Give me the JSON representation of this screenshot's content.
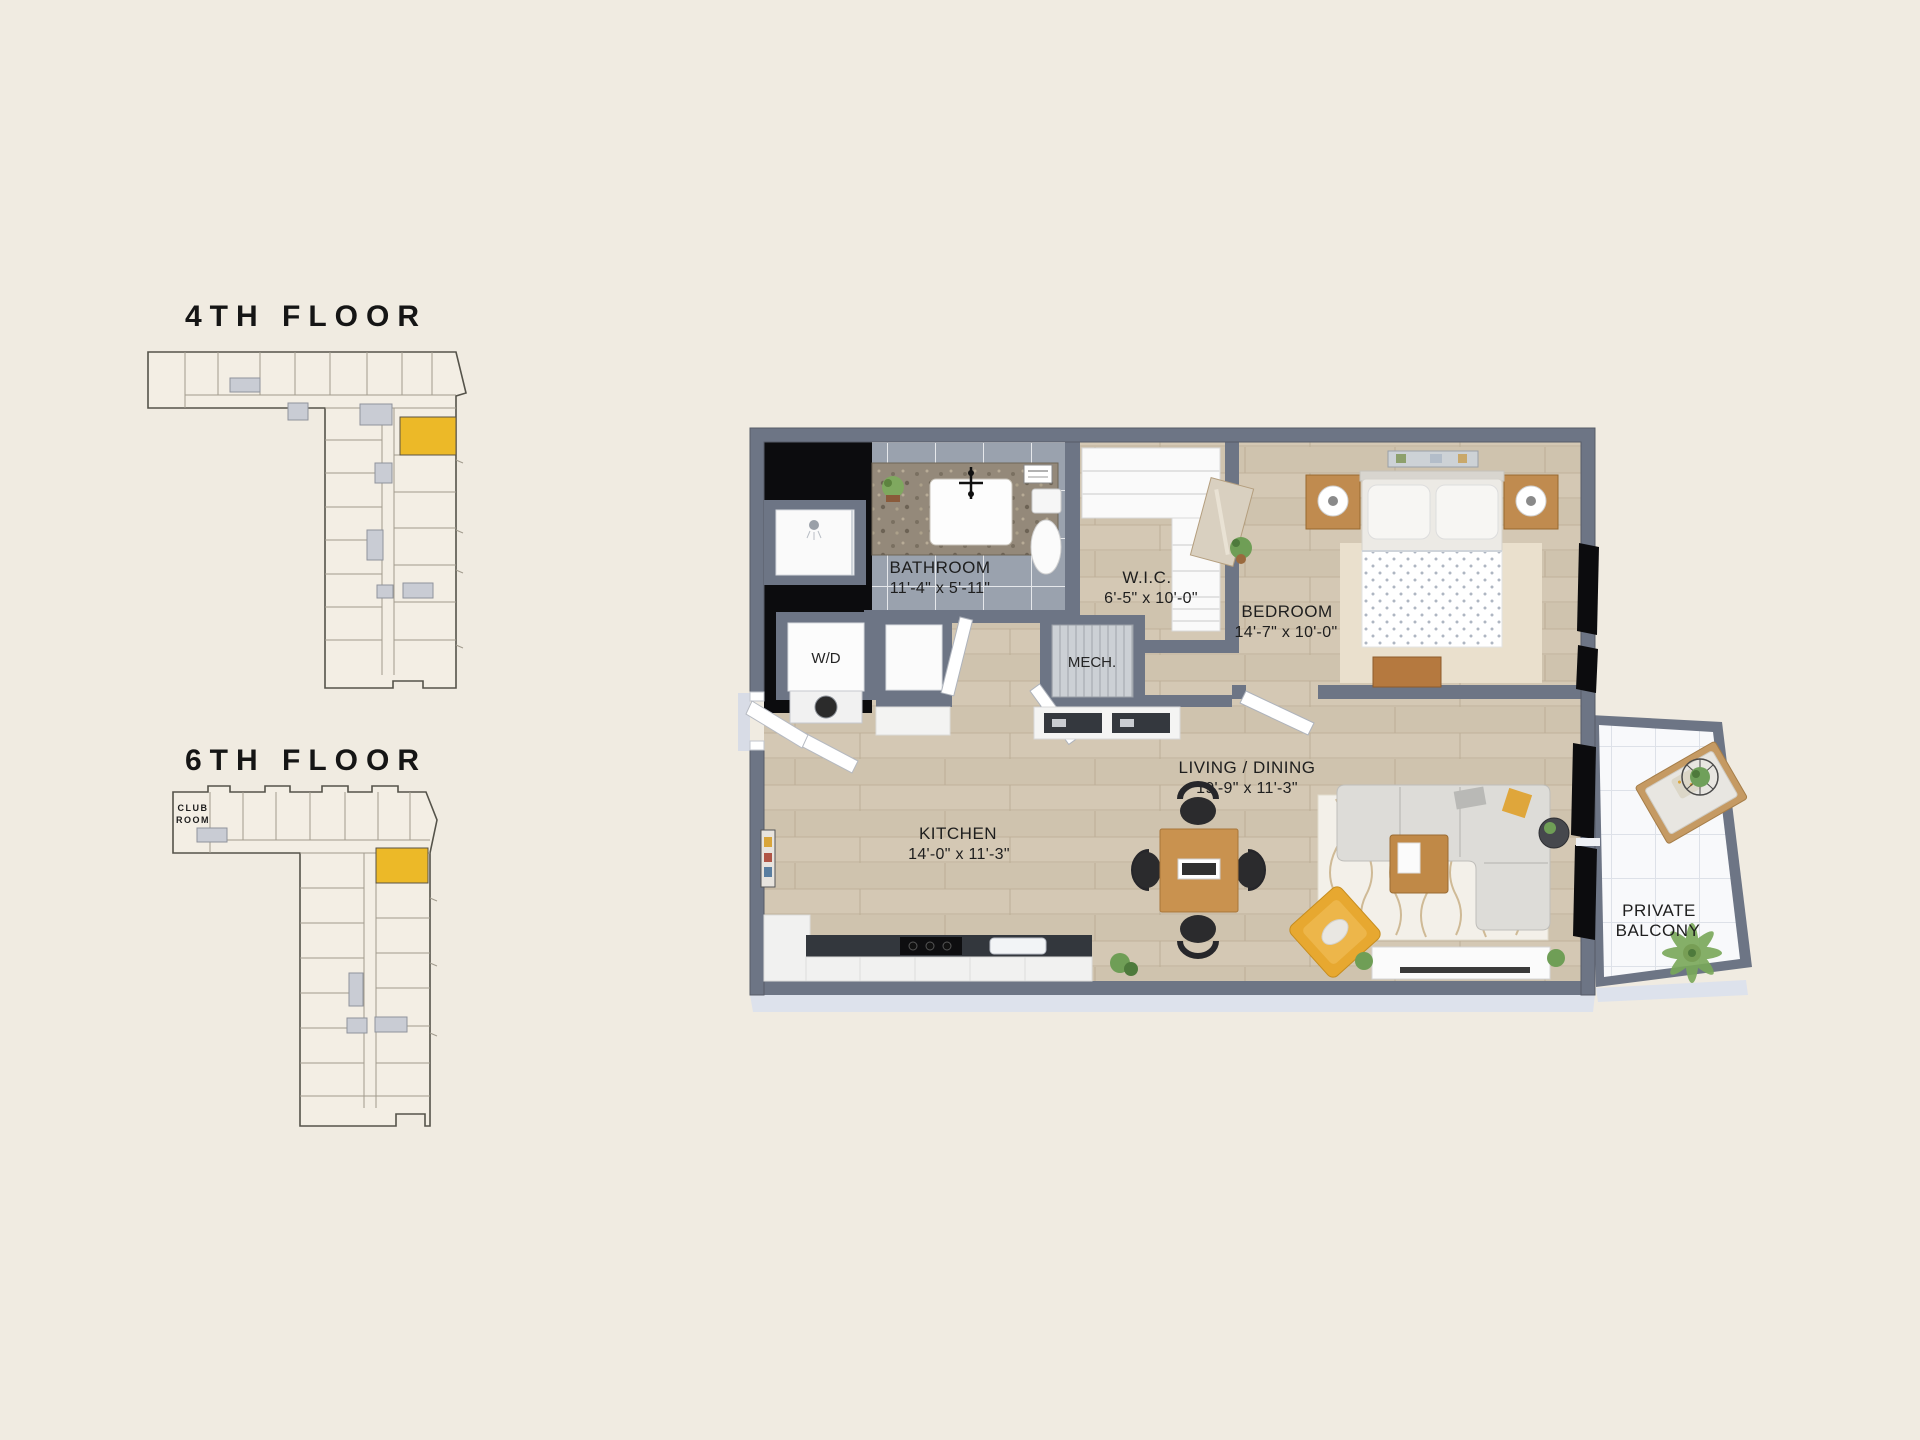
{
  "page": {
    "background": "#f0ebe1"
  },
  "colors": {
    "highlight_yellow": "#ecb928",
    "wall_gray": "#6d7585",
    "window_black": "#0c0c0e",
    "floor_wood": "#d3c7b3",
    "bathroom_tile": "#9aa2ae",
    "balcony_tile": "#f8f9fb",
    "slab_edge": "#dde2ec"
  },
  "locators": [
    {
      "title": "4TH FLOOR"
    },
    {
      "title": "6TH FLOOR",
      "club_room_line1": "CLUB",
      "club_room_line2": "ROOM"
    }
  ],
  "plan": {
    "rooms": {
      "bathroom": {
        "name": "BATHROOM",
        "dims": "11'-4\" x 5'-11\""
      },
      "wic": {
        "name": "W.I.C.",
        "dims": "6'-5\" x 10'-0\""
      },
      "bedroom": {
        "name": "BEDROOM",
        "dims": "14'-7\" x 10'-0\""
      },
      "kitchen": {
        "name": "KITCHEN",
        "dims": "14'-0\" x 11'-3\""
      },
      "living_dining": {
        "name": "LIVING / DINING",
        "dims": "19'-9\" x 11'-3\""
      },
      "balcony": {
        "line1": "PRIVATE",
        "line2": "BALCONY"
      },
      "washer_dryer": {
        "name": "W/D"
      },
      "mech": {
        "name": "MECH."
      }
    }
  }
}
